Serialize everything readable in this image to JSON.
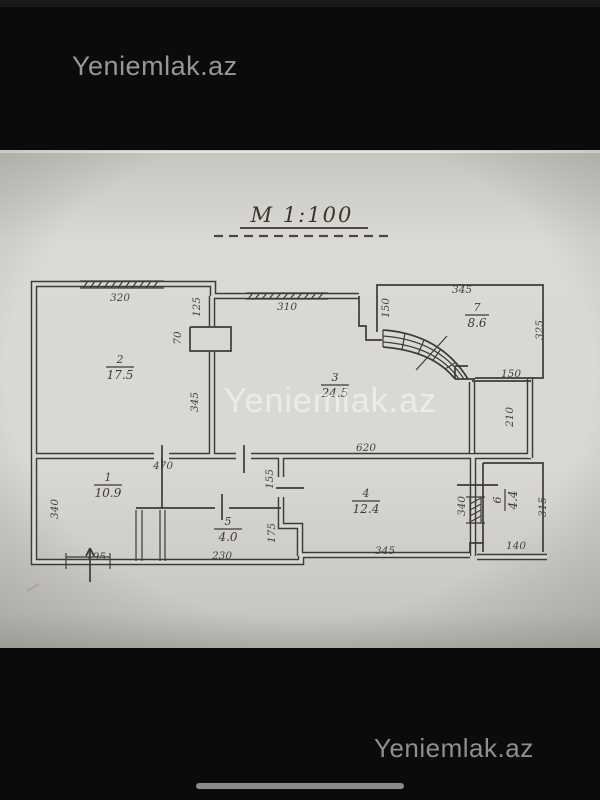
{
  "overlay": {
    "brand_top": "Yeniemlak.az",
    "brand_bottom": "Yeniemlak.az",
    "watermark_center": "Yeniemlak.az"
  },
  "plan": {
    "scale_title": "M 1:100",
    "rooms": [
      {
        "id": "1",
        "area": "10.9"
      },
      {
        "id": "2",
        "area": "17.5"
      },
      {
        "id": "3",
        "area": "24.5"
      },
      {
        "id": "4",
        "area": "12.4"
      },
      {
        "id": "5",
        "area": "4.0"
      },
      {
        "id": "6",
        "area": "4.4"
      },
      {
        "id": "7",
        "area": "8.6"
      }
    ],
    "dims": {
      "room2_top": "320",
      "room3_top": "310",
      "room7_top": "345",
      "wall23_upper": "125",
      "shaft_width": "70",
      "wall23_lower": "345",
      "room7_left": "150",
      "room7_right": "325",
      "ledge_width": "150",
      "ledge_height": "210",
      "hall_top": "620",
      "room1_top": "470",
      "left_side": "340",
      "niche_upper": "155",
      "niche_lower": "175",
      "room1_bottom": "195",
      "room5_bottom": "230",
      "room4_bottom": "345",
      "room4_right": "340",
      "room6_right": "315",
      "room6_bottom": "140"
    }
  },
  "colors": {
    "paper": "#d9d7d1",
    "ink": "#3d3b37",
    "bar": "#0b0b0b",
    "watermark_gray": "#979797"
  }
}
